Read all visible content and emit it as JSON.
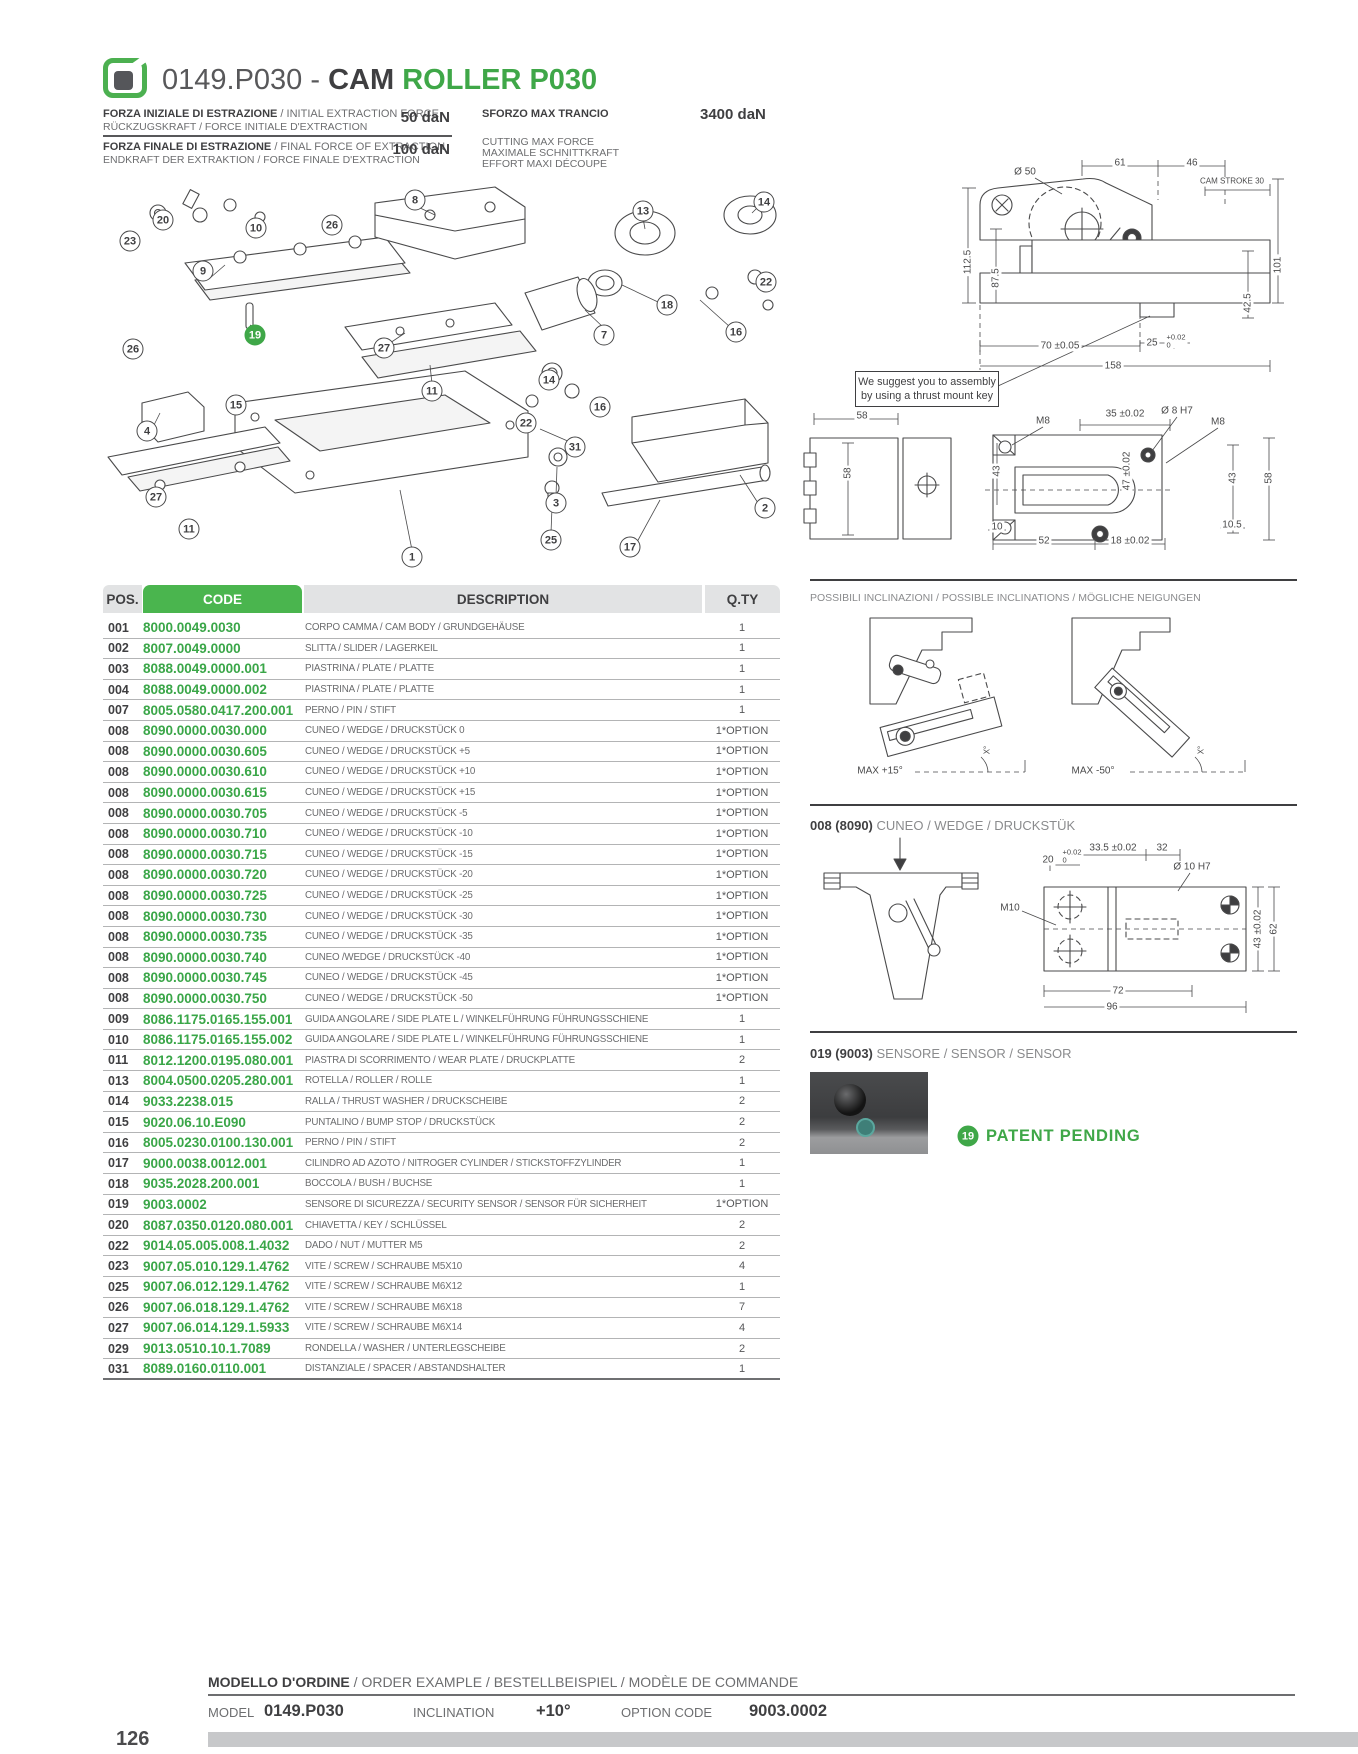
{
  "page_number": "126",
  "colors": {
    "green": "#3fa748",
    "green_header": "#4ab54e",
    "dark": "#3f3f41",
    "gray": "#6d6e70"
  },
  "header": {
    "title_prefix": "0149.P030 - ",
    "title_cam": "CAM ",
    "title_model": "ROLLER P030",
    "spec_rows": [
      {
        "l1b": "FORZA INIZIALE DI ESTRAZIONE",
        "l1r": " / INITIAL EXTRACTION FORCE",
        "l2": "RÜCKZUGSKRAFT / FORCE INITIALE D'EXTRACTION",
        "value": "50 daN"
      },
      {
        "l1b": "FORZA FINALE DI ESTRAZIONE",
        "l1r": " / FINAL FORCE OF EXTRACTION",
        "l2": "ENDKRAFT DER EXTRAKTION / FORCE FINALE D'EXTRACTION",
        "value": "100 daN"
      }
    ],
    "max_cut": {
      "title": "SFORZO MAX TRANCIO",
      "value": "3400 daN",
      "l1": "CUTTING MAX FORCE",
      "l2": "MAXIMALE SCHNITTKRAFT",
      "l3": "EFFORT MAXI DÉCOUPE"
    }
  },
  "exploded": {
    "balloons": [
      {
        "n": "8",
        "x": 415,
        "y": 200
      },
      {
        "n": "13",
        "x": 643,
        "y": 211
      },
      {
        "n": "14",
        "x": 764,
        "y": 202
      },
      {
        "n": "20",
        "x": 163,
        "y": 220
      },
      {
        "n": "10",
        "x": 256,
        "y": 228
      },
      {
        "n": "26",
        "x": 332,
        "y": 225
      },
      {
        "n": "23",
        "x": 130,
        "y": 241
      },
      {
        "n": "9",
        "x": 203,
        "y": 271
      },
      {
        "n": "22",
        "x": 766,
        "y": 282
      },
      {
        "n": "18",
        "x": 667,
        "y": 305
      },
      {
        "n": "16",
        "x": 736,
        "y": 332
      },
      {
        "n": "19",
        "x": 255,
        "y": 335,
        "green": true
      },
      {
        "n": "7",
        "x": 604,
        "y": 335
      },
      {
        "n": "27",
        "x": 384,
        "y": 348
      },
      {
        "n": "26",
        "x": 133,
        "y": 349
      },
      {
        "n": "14",
        "x": 549,
        "y": 380
      },
      {
        "n": "11",
        "x": 432,
        "y": 391
      },
      {
        "n": "15",
        "x": 236,
        "y": 405
      },
      {
        "n": "16",
        "x": 600,
        "y": 407
      },
      {
        "n": "22",
        "x": 526,
        "y": 423
      },
      {
        "n": "4",
        "x": 147,
        "y": 431
      },
      {
        "n": "31",
        "x": 575,
        "y": 447
      },
      {
        "n": "27",
        "x": 156,
        "y": 497
      },
      {
        "n": "3",
        "x": 556,
        "y": 503
      },
      {
        "n": "2",
        "x": 765,
        "y": 508
      },
      {
        "n": "11",
        "x": 189,
        "y": 529
      },
      {
        "n": "25",
        "x": 551,
        "y": 540
      },
      {
        "n": "17",
        "x": 630,
        "y": 547
      },
      {
        "n": "1",
        "x": 412,
        "y": 557
      }
    ]
  },
  "dims_top": {
    "d50": "Ø  50",
    "d61": "61",
    "d46": "46",
    "stroke": "CAM STROKE 30",
    "d112": "112.5",
    "d87": "87.5",
    "d101": "101",
    "d42": "42.5",
    "d70": "70 ±0.05",
    "d25": "25",
    "tol_t": "+0.02",
    "tol_b": "0",
    "d158": "158",
    "note1": "We suggest you to assembly",
    "note2": "by using a thrust mount key"
  },
  "dims_mid": {
    "d58t": "58",
    "d58l": "58",
    "m8l": "M8",
    "d35": "35 ±0.02",
    "d8h7": "Ø  8 H7",
    "m8r": "M8",
    "d43l": "43",
    "d47": "47 ±0.02",
    "d43r": "43",
    "d58r": "58",
    "d10": "10",
    "d105": "10.5",
    "d52": "52",
    "d18": "18 ±0.02"
  },
  "table": {
    "headers": {
      "pos": "POS.",
      "code": "CODE",
      "desc": "DESCRIPTION",
      "qty": "Q.TY"
    },
    "rows": [
      [
        "001",
        "8000.0049.0030",
        "CORPO CAMMA / CAM BODY / GRUNDGEHÄUSE",
        "1"
      ],
      [
        "002",
        "8007.0049.0000",
        "SLITTA / SLIDER / LAGERKEIL",
        "1"
      ],
      [
        "003",
        "8088.0049.0000.001",
        "PIASTRINA / PLATE / PLATTE",
        "1"
      ],
      [
        "004",
        "8088.0049.0000.002",
        "PIASTRINA / PLATE / PLATTE",
        "1"
      ],
      [
        "007",
        "8005.0580.0417.200.001",
        "PERNO / PIN / STIFT",
        "1"
      ],
      [
        "008",
        "8090.0000.0030.000",
        "CUNEO / WEDGE / DRUCKSTÜCK 0",
        "1*OPTION"
      ],
      [
        "008",
        "8090.0000.0030.605",
        "CUNEO / WEDGE / DRUCKSTÜCK +5",
        "1*OPTION"
      ],
      [
        "008",
        "8090.0000.0030.610",
        "CUNEO / WEDGE / DRUCKSTÜCK +10",
        "1*OPTION"
      ],
      [
        "008",
        "8090.0000.0030.615",
        "CUNEO / WEDGE / DRUCKSTÜCK +15",
        "1*OPTION"
      ],
      [
        "008",
        "8090.0000.0030.705",
        "CUNEO / WEDGE / DRUCKSTÜCK -5",
        "1*OPTION"
      ],
      [
        "008",
        "8090.0000.0030.710",
        "CUNEO / WEDGE / DRUCKSTÜCK -10",
        "1*OPTION"
      ],
      [
        "008",
        "8090.0000.0030.715",
        "CUNEO / WEDGE / DRUCKSTÜCK -15",
        "1*OPTION"
      ],
      [
        "008",
        "8090.0000.0030.720",
        "CUNEO / WEDGE / DRUCKSTÜCK -20",
        "1*OPTION"
      ],
      [
        "008",
        "8090.0000.0030.725",
        "CUNEO / WEDGE / DRUCKSTÜCK -25",
        "1*OPTION"
      ],
      [
        "008",
        "8090.0000.0030.730",
        "CUNEO / WEDGE / DRUCKSTÜCK -30",
        "1*OPTION"
      ],
      [
        "008",
        "8090.0000.0030.735",
        "CUNEO / WEDGE / DRUCKSTÜCK -35",
        "1*OPTION"
      ],
      [
        "008",
        "8090.0000.0030.740",
        "CUNEO /WEDGE / DRUCKSTÜCK -40",
        "1*OPTION"
      ],
      [
        "008",
        "8090.0000.0030.745",
        "CUNEO / WEDGE / DRUCKSTÜCK -45",
        "1*OPTION"
      ],
      [
        "008",
        "8090.0000.0030.750",
        "CUNEO / WEDGE / DRUCKSTÜCK -50",
        "1*OPTION"
      ],
      [
        "009",
        "8086.1175.0165.155.001",
        "GUIDA ANGOLARE / SIDE PLATE L / WINKELFÜHRUNG FÜHRUNGSSCHIENE",
        "1"
      ],
      [
        "010",
        "8086.1175.0165.155.002",
        "GUIDA ANGOLARE / SIDE PLATE L / WINKELFÜHRUNG FÜHRUNGSSCHIENE",
        "1"
      ],
      [
        "011",
        "8012.1200.0195.080.001",
        "PIASTRA DI SCORRIMENTO / WEAR PLATE / DRUCKPLATTE",
        "2"
      ],
      [
        "013",
        "8004.0500.0205.280.001",
        "ROTELLA / ROLLER / ROLLE",
        "1"
      ],
      [
        "014",
        "9033.2238.015",
        "RALLA / THRUST WASHER / DRUCKSCHEIBE",
        "2"
      ],
      [
        "015",
        "9020.06.10.E090",
        "PUNTALINO / BUMP STOP / DRUCKSTÜCK",
        "2"
      ],
      [
        "016",
        "8005.0230.0100.130.001",
        "PERNO / PIN / STIFT",
        "2"
      ],
      [
        "017",
        "9000.0038.0012.001",
        "CILINDRO AD AZOTO / NITROGER CYLINDER / STICKSTOFFZYLINDER",
        "1"
      ],
      [
        "018",
        "9035.2028.200.001",
        "BOCCOLA / BUSH / BUCHSE",
        "1"
      ],
      [
        "019",
        "9003.0002",
        "SENSORE DI SICUREZZA / SECURITY SENSOR / SENSOR FÜR SICHERHEIT",
        "1*OPTION"
      ],
      [
        "020",
        "8087.0350.0120.080.001",
        "CHIAVETTA / KEY / SCHLÜSSEL",
        "2"
      ],
      [
        "022",
        "9014.05.005.008.1.4032",
        "DADO / NUT / MUTTER M5",
        "2"
      ],
      [
        "023",
        "9007.05.010.129.1.4762",
        "VITE / SCREW / SCHRAUBE M5X10",
        "4"
      ],
      [
        "025",
        "9007.06.012.129.1.4762",
        "VITE / SCREW / SCHRAUBE M6X12",
        "1"
      ],
      [
        "026",
        "9007.06.018.129.1.4762",
        "VITE / SCREW / SCHRAUBE M6X18",
        "7"
      ],
      [
        "027",
        "9007.06.014.129.1.5933",
        "VITE / SCREW / SCHRAUBE M6X14",
        "4"
      ],
      [
        "029",
        "9013.0510.10.1.7089",
        "RONDELLA / WASHER / UNTERLEGSCHEIBE",
        "2"
      ],
      [
        "031",
        "8089.0160.0110.001",
        "DISTANZIALE / SPACER / ABSTANDSHALTER",
        "1"
      ]
    ]
  },
  "inclinations": {
    "title": "POSSIBILI INCLINAZIONI / POSSIBLE INCLINATIONS / MÖGLICHE NEIGUNGEN",
    "max_plus": "MAX +15°",
    "max_minus": "MAX -50°",
    "angle": "X°"
  },
  "wedge": {
    "pos": "008 (8090)",
    "label": "CUNEO / WEDGE / DRUCKSTÜK",
    "d335": "33.5 ±0.02",
    "d32": "32",
    "d20": "20",
    "tol_t": "+0.02",
    "tol_b": "0",
    "d10h7": "Ø 10 H7",
    "m10": "M10",
    "d43": "43 ±0.02",
    "d62": "62",
    "d72": "72",
    "d96": "96"
  },
  "sensor": {
    "pos": "019 (9003)",
    "label": "SENSORE / SENSOR / SENSOR",
    "badge": "19",
    "patent": "PATENT PENDING"
  },
  "order": {
    "title_bold": "MODELLO D'ORDINE",
    "title_rest": " / ORDER EXAMPLE / BESTELLBEISPIEL / MODÈLE DE COMMANDE",
    "model_label": "MODEL",
    "model": "0149.P030",
    "incl_label": "INCLINATION",
    "incl": "+10°",
    "opt_label": "OPTION CODE",
    "opt": "9003.0002"
  }
}
